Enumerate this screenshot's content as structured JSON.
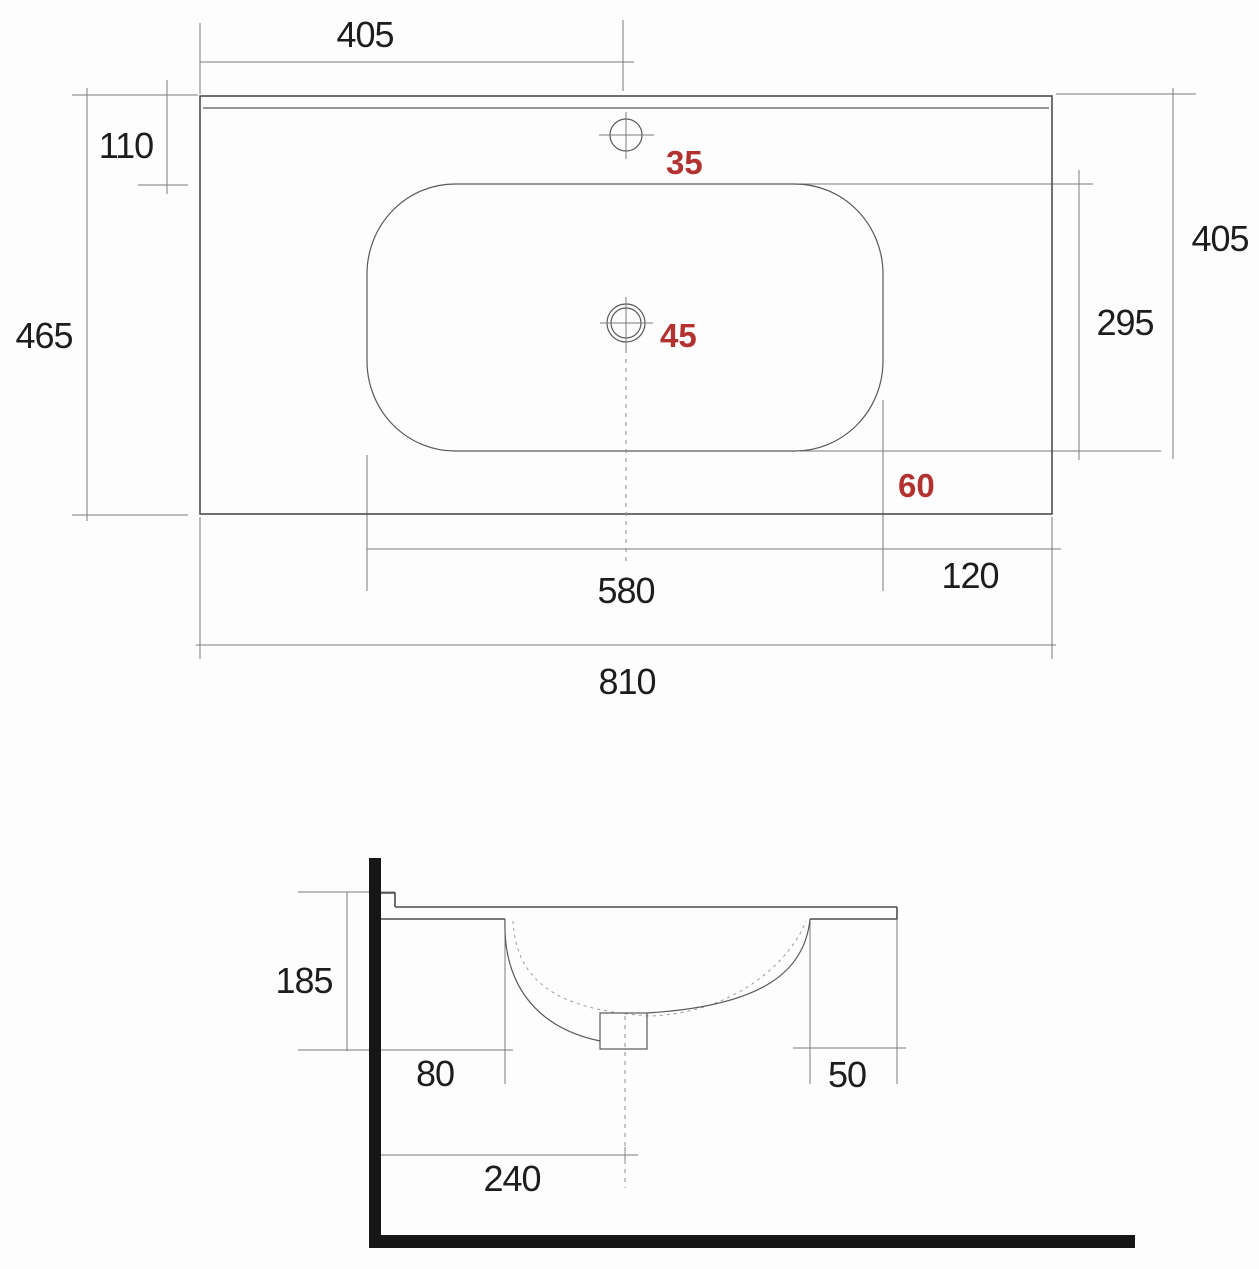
{
  "colors": {
    "background": "#fdfdfd",
    "outline_line": "#4d4d4d",
    "dimension_line": "#7a7a7a",
    "dimension_text": "#1d1d1d",
    "accent_red": "#b23230",
    "wall_black": "#161616"
  },
  "top_view": {
    "dimensions": {
      "faucet_center_from_left": "405",
      "top_edge_to_basin": "110",
      "overall_depth": "465",
      "faucet_hole_diameter": "35",
      "drain_hole_diameter": "45",
      "top_edge_to_basin_bottom": "405",
      "basin_depth": "295",
      "basin_to_front_edge": "60",
      "basin_width": "580",
      "basin_to_right_edge": "120",
      "overall_width": "810"
    }
  },
  "section_view": {
    "dimensions": {
      "edge_height": "185",
      "wall_to_basin_back": "80",
      "basin_front_to_edge": "50",
      "wall_to_drain_center": "240"
    }
  }
}
